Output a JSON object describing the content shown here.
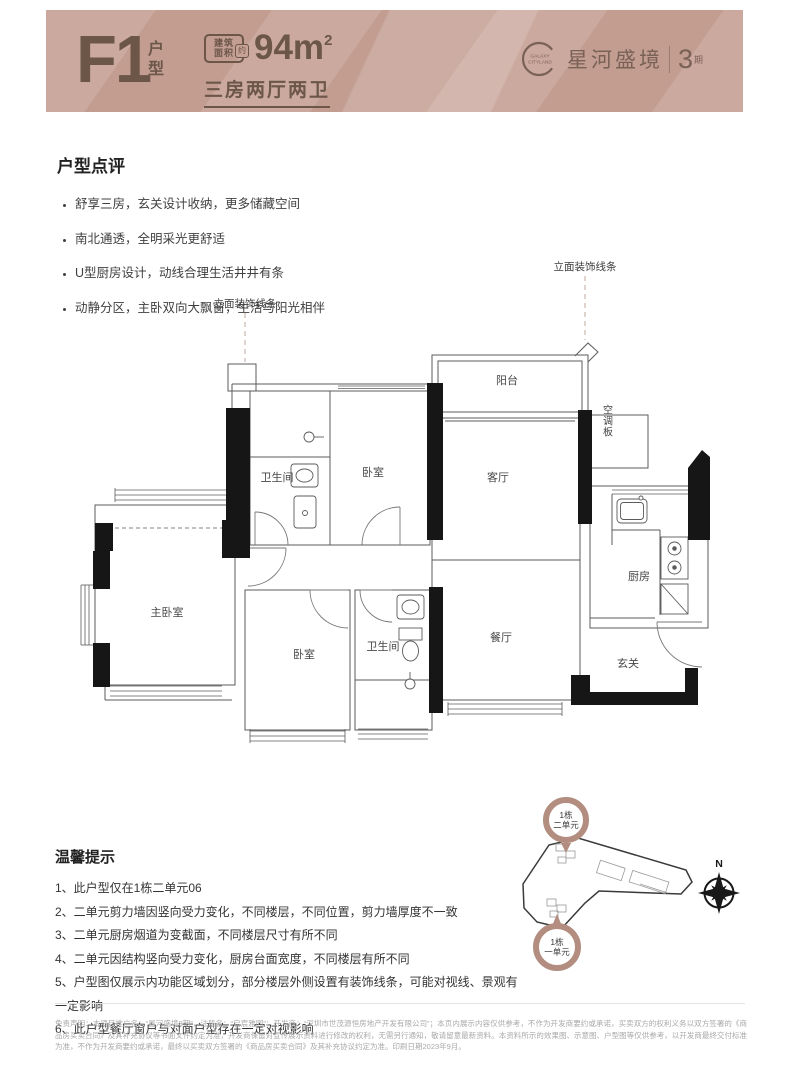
{
  "header": {
    "model_code": "F1",
    "model_label_top": "户",
    "model_label_bottom": "型",
    "area_tag_line1": "建筑",
    "area_tag_line2": "面积",
    "area_tag_approx": "约",
    "area_value": "94m",
    "area_exponent": "2",
    "subtitle": "三房两厅两卫",
    "logo": {
      "ring_text_top": "GALAXY",
      "ring_text_bottom": "CITYLAND",
      "brand_name": "星河盛境",
      "phase_number": "3",
      "phase_unit": "期"
    }
  },
  "review": {
    "title": "户型点评",
    "bullets": [
      "舒享三房，玄关设计收纳，更多储藏空间",
      "南北通透，全明采光更舒适",
      "U型厨房设计，动线合理生活井井有条",
      "动静分区，主卧双向大飘窗，生活与阳光相伴"
    ]
  },
  "floorplan": {
    "decor_left": "立面装饰线条",
    "decor_right": "立面装饰线条",
    "rooms": {
      "balcony": "阳台",
      "living": "客厅",
      "ac_panel": "空调板",
      "kitchen": "厨房",
      "bath1": "卫生间",
      "bed1": "卧室",
      "master": "主卧室",
      "bed2": "卧室",
      "bath2": "卫生间",
      "dining": "餐厅",
      "foyer": "玄关"
    }
  },
  "tips": {
    "title": "温馨提示",
    "items": [
      "1、此户型仅在1栋二单元06",
      "2、二单元剪力墙因竖向受力变化，不同楼层，不同位置，剪力墙厚度不一致",
      "3、二单元厨房烟道为变截面，不同楼层尺寸有所不同",
      "4、二单元因结构竖向受力变化，厨房台面宽度，不同楼层有所不同",
      "5、户型图仅展示内功能区域划分，部分楼层外侧设置有装饰线条，可能对视线、景观有一定影响",
      "6、此户型餐厅窗户与对面户型存在一定对视影响"
    ]
  },
  "siteplan": {
    "badge_top": {
      "line1": "1栋",
      "line2": "二单元"
    },
    "badge_bottom": {
      "line1": "1栋",
      "line2": "一单元"
    },
    "compass_label": "N"
  },
  "footer": {
    "disclaimer": "免责声明：本项目推广名：“星河盛境3期”，注册名：“启宸雅园”；开发商：“深圳市世茂源恒房地产开发有限公司”；本页内展示内容仅供参考，不作为开发商要约或承诺，买卖双方的权利义务以双方签署的《商品房买卖合同》及其补充协议等书面文件约定为准，开发商保留对宣传展示资料进行修改的权利，无需另行通知，敬请留意最新资料。本资料所示的效果图、示意图、户型图等仅供参考，以开发商最终交付标准为准，不作为开发商要约或承诺，最终以买卖双方签署的《商品房买卖合同》及其补充协议约定为准。印刷日期2023年9月。"
  },
  "colors": {
    "banner_background": "#c7a296",
    "banner_text": "#6b5648",
    "logo_brown": "#7a6156",
    "accent_rose": "#b28d80",
    "plan_wall_fill": "#161616",
    "body_text": "#3a3a3a",
    "disclaimer_text": "#a9a9a9"
  }
}
